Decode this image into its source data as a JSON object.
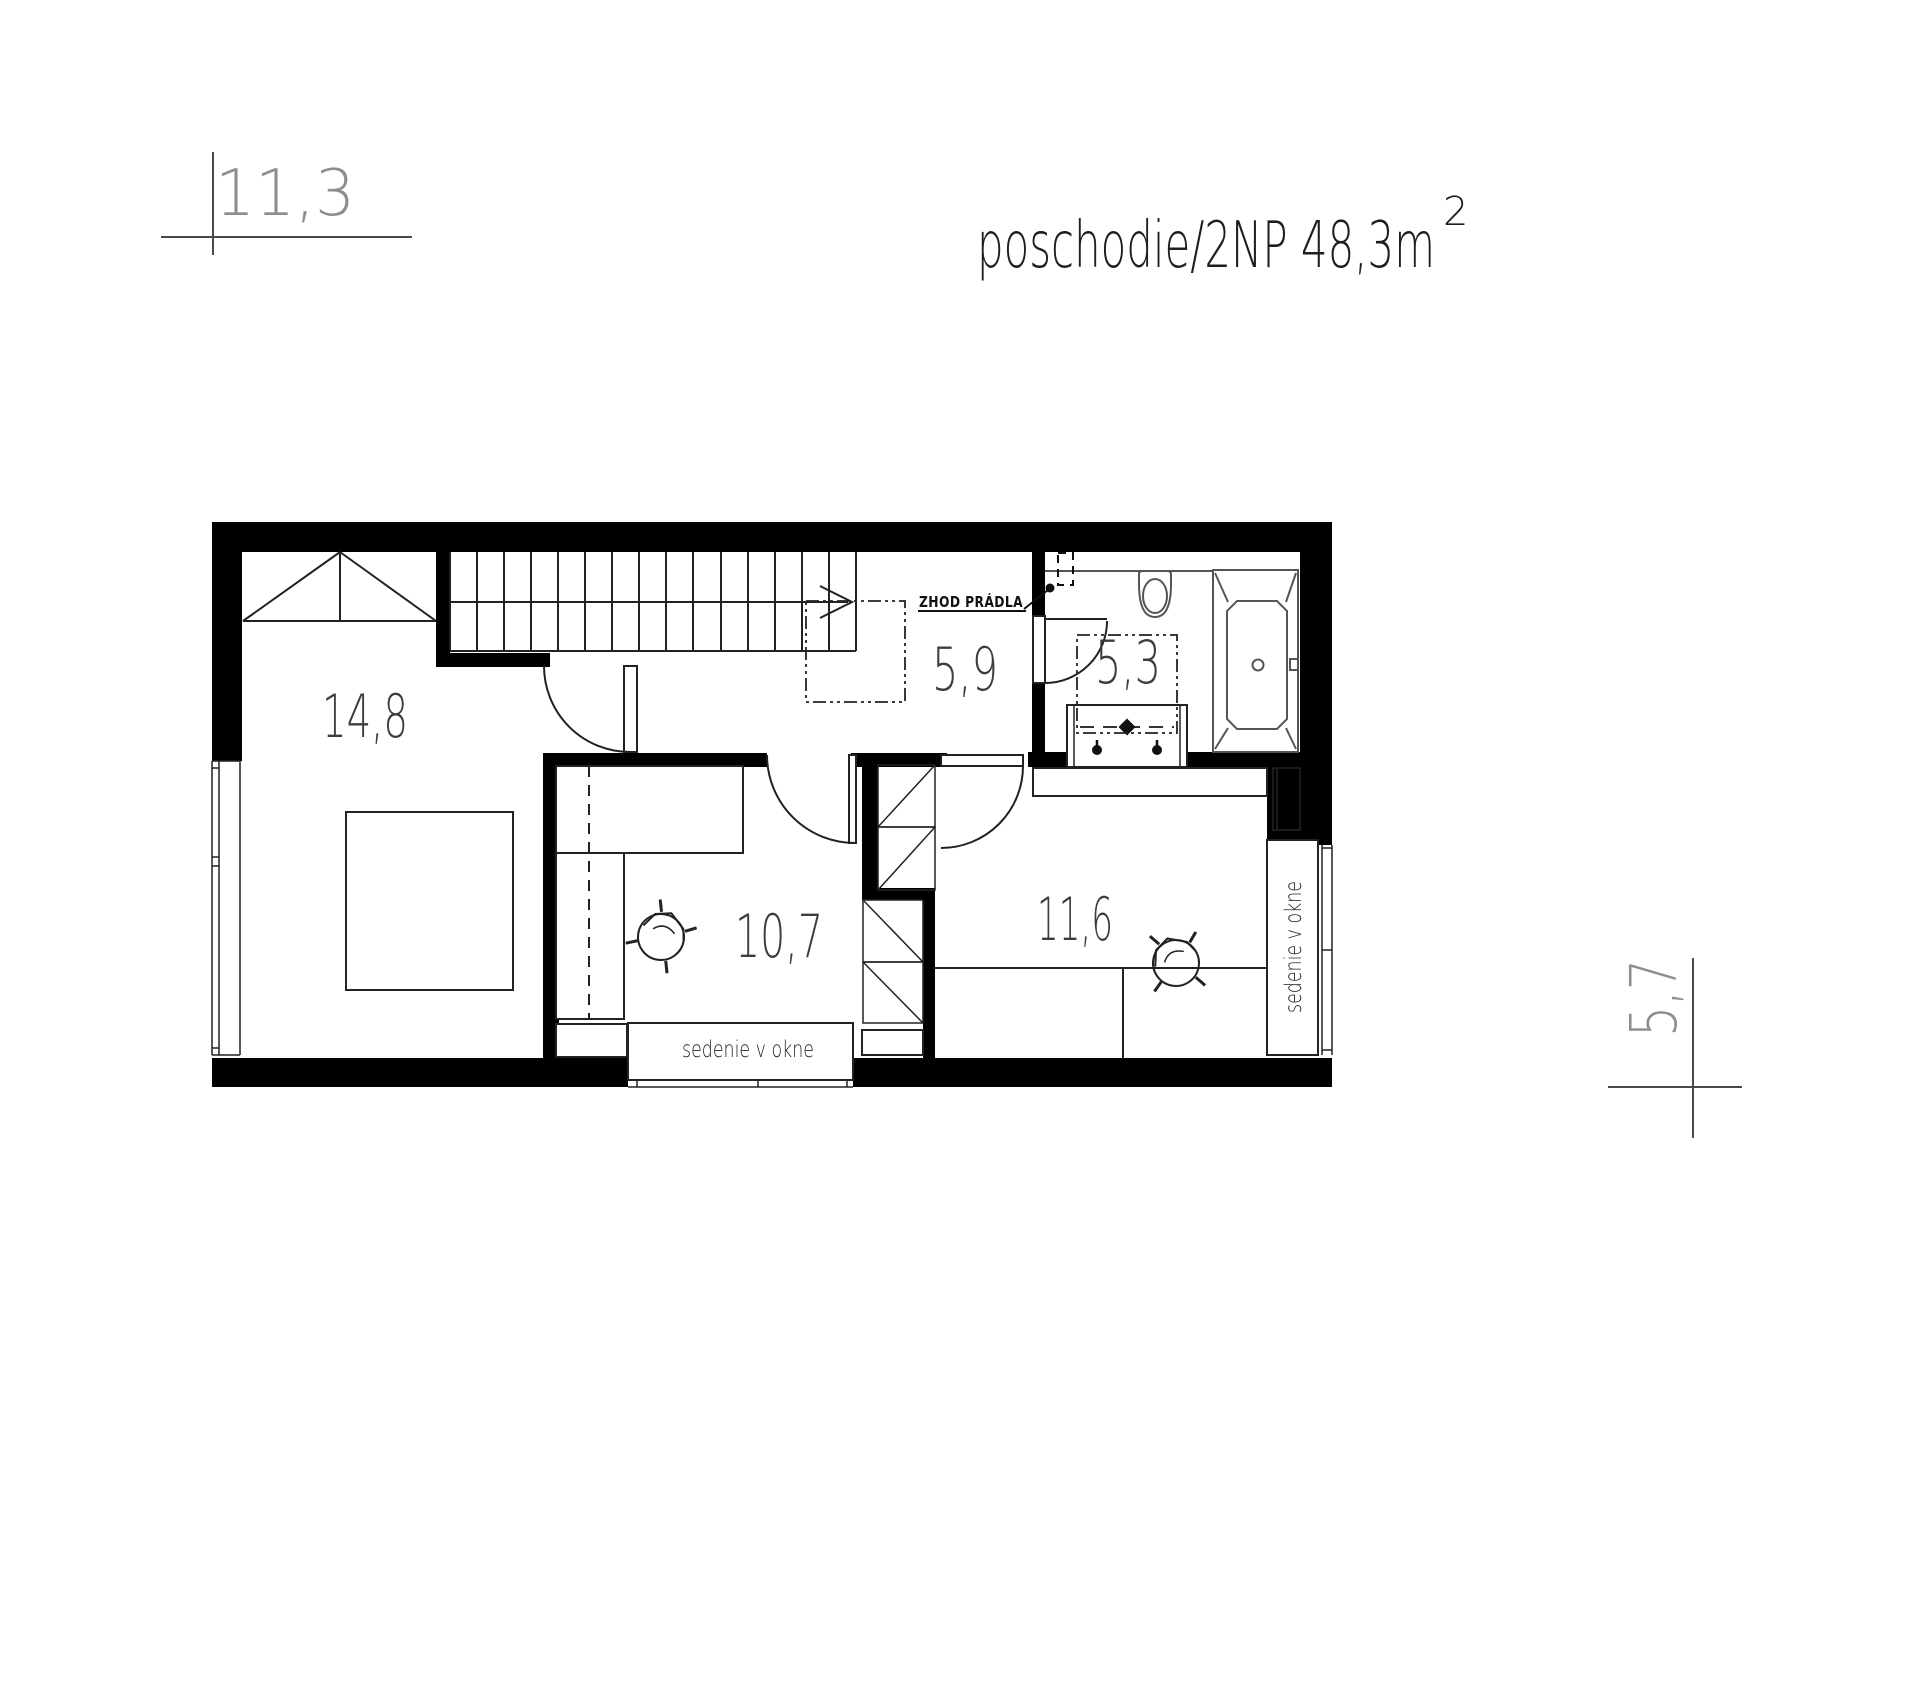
{
  "title": {
    "main": "poschodie/2NP 48,3m",
    "sup": "2"
  },
  "dimensions": {
    "top": "11,3",
    "right": "5,7"
  },
  "rooms": [
    {
      "id": "bedroom-left",
      "area": "14,8"
    },
    {
      "id": "hall-staircase",
      "area": "5,9"
    },
    {
      "id": "bathroom",
      "area": "5,3"
    },
    {
      "id": "bedroom-middle",
      "area": "10,7"
    },
    {
      "id": "bedroom-right",
      "area": "11,6"
    }
  ],
  "annotations": {
    "laundry_chute": "ZHOD PRÁDLA",
    "window_seat_bottom": "sedenie v okne",
    "window_seat_right": "sedenie v okne"
  },
  "colors": {
    "wall": "#000000",
    "line": "#222222",
    "fixture": "#555555",
    "dimension": "#8d8d8d"
  }
}
